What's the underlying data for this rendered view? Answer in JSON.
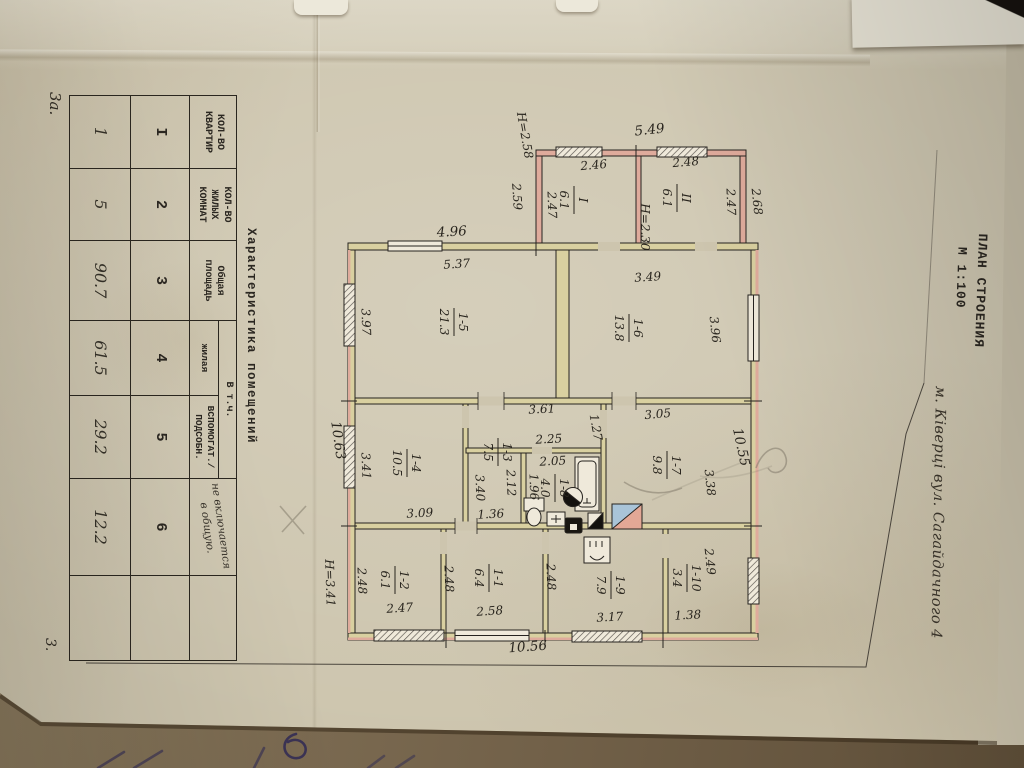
{
  "page": {
    "sheet_note": "3а.",
    "page_number": "3.",
    "title_line1": "ПЛАН СТРОЕНИЯ",
    "title_line2": "М 1:100",
    "address": "м. Ківерці  вул. Сагайдачного 4"
  },
  "table": {
    "title": "Характеристика  помещений",
    "headers": {
      "col1": "КОЛ-ВО КВАРТИР",
      "col2": "КОЛ-ВО ЖИЛЫХ КОМНАТ",
      "col3": "Общая площадь",
      "group45": "В т.ч.",
      "col4": "жилая",
      "col5": "ВСПОМОГАТ./ ПОДСОБН.",
      "col6_note": "не включается в общую."
    },
    "column_numbers": [
      "I",
      "2",
      "3",
      "4",
      "5",
      "6"
    ],
    "values": [
      "1",
      "5",
      "90.7",
      "61.5",
      "29.2",
      "12.2"
    ]
  },
  "plan": {
    "scale": "1:100",
    "rooms": [
      {
        "num": "I",
        "area": "6.1",
        "x": 575,
        "y": 200
      },
      {
        "num": "II",
        "area": "6.1",
        "x": 678,
        "y": 198
      },
      {
        "num": "1-5",
        "area": "21.3",
        "x": 455,
        "y": 322
      },
      {
        "num": "1-6",
        "area": "13.8",
        "x": 630,
        "y": 328
      },
      {
        "num": "1-4",
        "area": "10.5",
        "x": 408,
        "y": 463
      },
      {
        "num": "1-3",
        "area": "7.5",
        "x": 499,
        "y": 452
      },
      {
        "num": "1-8",
        "area": "4.0",
        "x": 556,
        "y": 488
      },
      {
        "num": "1-7",
        "area": "9.8",
        "x": 668,
        "y": 465
      },
      {
        "num": "1-2",
        "area": "6.1",
        "x": 396,
        "y": 580
      },
      {
        "num": "1-1",
        "area": "6.4",
        "x": 490,
        "y": 578
      },
      {
        "num": "1-9",
        "area": "7.9",
        "x": 612,
        "y": 585
      },
      {
        "num": "1-10",
        "area": "3.4",
        "x": 688,
        "y": 578
      }
    ],
    "labels": [
      {
        "t": "5.49",
        "x": 650,
        "y": 134,
        "r": -6,
        "big": 1
      },
      {
        "t": "2.46",
        "x": 594,
        "y": 169,
        "r": -5
      },
      {
        "t": "2.48",
        "x": 686,
        "y": 166,
        "r": -5
      },
      {
        "t": "Н=2.58",
        "x": 521,
        "y": 136,
        "r": 80
      },
      {
        "t": "2.59",
        "x": 513,
        "y": 197,
        "r": 86
      },
      {
        "t": "2.47",
        "x": 548,
        "y": 205,
        "r": 88
      },
      {
        "t": "Н=2.30",
        "x": 641,
        "y": 227,
        "r": 90
      },
      {
        "t": "2.47",
        "x": 727,
        "y": 202,
        "r": 88
      },
      {
        "t": "2.68",
        "x": 753,
        "y": 202,
        "r": 84
      },
      {
        "t": "4.96",
        "x": 452,
        "y": 236,
        "r": -3,
        "big": 1
      },
      {
        "t": "5.37",
        "x": 457,
        "y": 268,
        "r": -4
      },
      {
        "t": "3.49",
        "x": 648,
        "y": 281,
        "r": -4
      },
      {
        "t": "3.97",
        "x": 362,
        "y": 322,
        "r": 88
      },
      {
        "t": "3.96",
        "x": 711,
        "y": 330,
        "r": 84
      },
      {
        "t": "10.63",
        "x": 334,
        "y": 441,
        "r": 82,
        "big": 1
      },
      {
        "t": "10.55",
        "x": 737,
        "y": 448,
        "r": 78,
        "big": 1
      },
      {
        "t": "3.61",
        "x": 542,
        "y": 413,
        "r": -3
      },
      {
        "t": "1.27",
        "x": 592,
        "y": 428,
        "r": 80
      },
      {
        "t": "3.05",
        "x": 658,
        "y": 418,
        "r": -5
      },
      {
        "t": "2.25",
        "x": 549,
        "y": 443,
        "r": -3
      },
      {
        "t": "2.05",
        "x": 553,
        "y": 465,
        "r": -3
      },
      {
        "t": "3.41",
        "x": 362,
        "y": 466,
        "r": 88
      },
      {
        "t": "3.40",
        "x": 476,
        "y": 488,
        "r": 88
      },
      {
        "t": "2.12",
        "x": 507,
        "y": 483,
        "r": 88
      },
      {
        "t": "1.96",
        "x": 530,
        "y": 487,
        "r": 88
      },
      {
        "t": "3.38",
        "x": 706,
        "y": 483,
        "r": 84
      },
      {
        "t": "3.09",
        "x": 420,
        "y": 517,
        "r": -3
      },
      {
        "t": "1.36",
        "x": 491,
        "y": 518,
        "r": -3
      },
      {
        "t": "Н=3.41",
        "x": 326,
        "y": 583,
        "r": 88
      },
      {
        "t": "2.48",
        "x": 358,
        "y": 581,
        "r": 88
      },
      {
        "t": "2.48",
        "x": 445,
        "y": 579,
        "r": 88
      },
      {
        "t": "2.48",
        "x": 547,
        "y": 577,
        "r": 88
      },
      {
        "t": "2.49",
        "x": 706,
        "y": 562,
        "r": 84
      },
      {
        "t": "2.47",
        "x": 400,
        "y": 612,
        "r": -4
      },
      {
        "t": "2.58",
        "x": 490,
        "y": 615,
        "r": -4
      },
      {
        "t": "3.17",
        "x": 610,
        "y": 621,
        "r": -3
      },
      {
        "t": "1.38",
        "x": 688,
        "y": 619,
        "r": -3
      },
      {
        "t": "10.56",
        "x": 528,
        "y": 651,
        "r": -4,
        "big": 1
      }
    ],
    "colors": {
      "wall_fill": "#d9d0a0",
      "annex_wall_fill": "#dfab9c",
      "stove_blue": "#a9c4d8",
      "stove_pink": "#e3a896",
      "ink": "#26231f"
    }
  }
}
